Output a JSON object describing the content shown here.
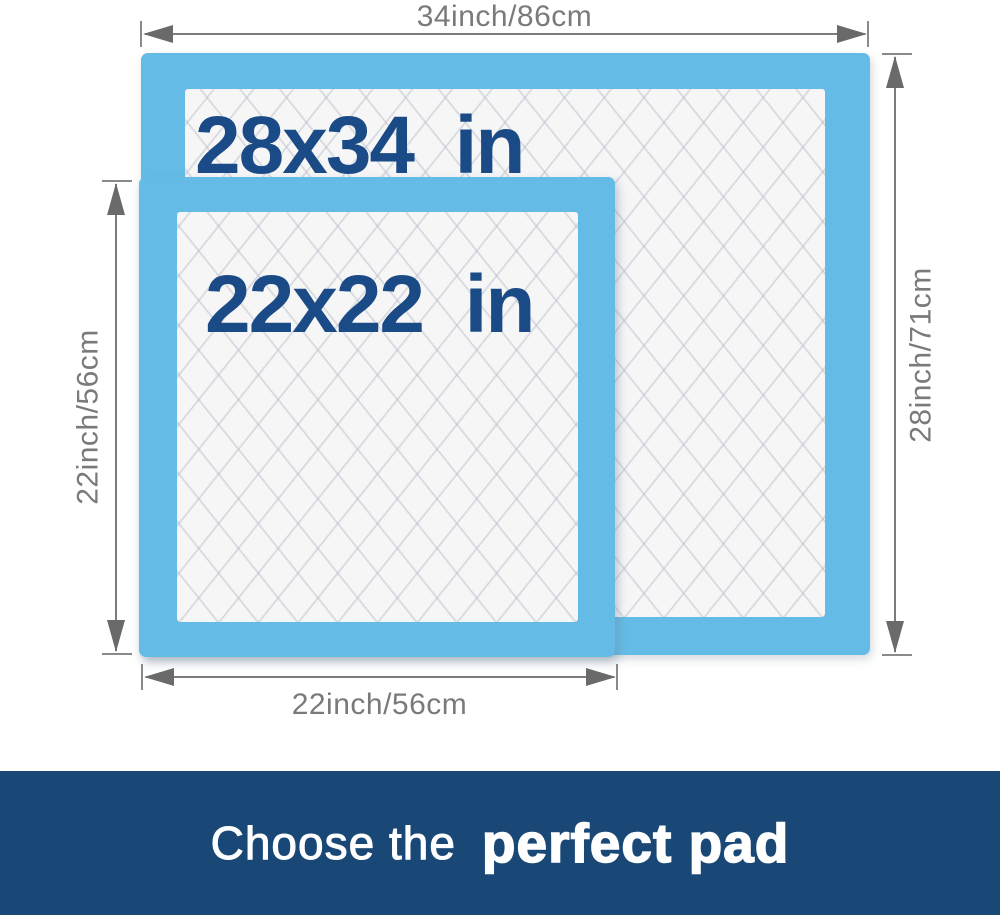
{
  "diagram": {
    "top_dimension": "34inch/86cm",
    "right_dimension": "28inch/71cm",
    "left_dimension": "22inch/56cm",
    "bottom_dimension": "22inch/56cm",
    "large_pad": {
      "size_label": "28x34  in"
    },
    "small_pad": {
      "size_label": "22x22  in"
    }
  },
  "banner": {
    "text_regular": "Choose the",
    "text_bold": "perfect pad"
  },
  "colors": {
    "pad_blue": "#64BCE6",
    "pad_core_white": "#F6F6F7",
    "size_text_blue": "#1B4B87",
    "dimension_gray": "#7A7A7A",
    "banner_bg": "#1A4876",
    "banner_text": "#FFFFFF"
  }
}
